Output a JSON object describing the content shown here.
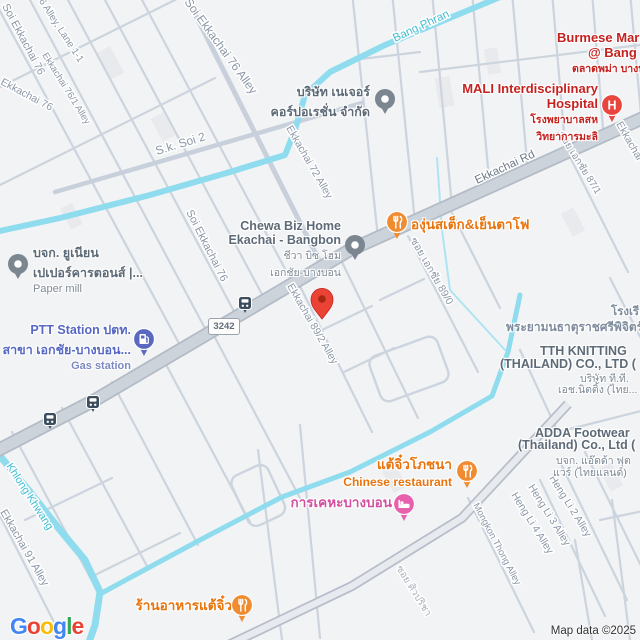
{
  "attribution": "Map data ©2025",
  "logo": {
    "letters": [
      "G",
      "o",
      "o",
      "g",
      "l",
      "e"
    ]
  },
  "route_shield": "3242",
  "canals": {
    "bang_phran": "Bang Phran",
    "khlong_khwang": "Khlong Khwang"
  },
  "streets": {
    "soi_ekkachai_76": "Soi Ekkachai 76",
    "ekkachai_76_lane_1_1": "Ekkachai 76 Alley, Lane 1-1",
    "ekkachai_76": "Ekkachai 76",
    "ekkachai_76_1_alley": "Ekkachai 76/1 Alley",
    "soi_ekkachai_76_alley": "Soi Ekkachai 76 Alley",
    "soi_ekkachai_76_lower": "Soi Ekkachai 76",
    "sk_soi_2": "S.k. Soi 2",
    "ekkachai_72_alley": "Ekkachai 72 Alley",
    "ekkachai_rd": "Ekkachai Rd",
    "ekkachai_clipped": "Ekkachai",
    "soi_ekachai_87_1": "ซอย เอกชัย 87/1",
    "soi_ekachai_89_0": "ซอย เอกชัย 89/0",
    "ekkachai_89_2_alley": "Ekkachai 89/2 Alley",
    "mongkon_thong_alley": "Mongkon Thong Alley",
    "heng_li_2_alley": "Heng Li 2 Alley",
    "heng_li_3_alley": "Heng Li 3 Alley",
    "heng_li_4_alley": "Heng Li 4 Alley",
    "ekkachai_91_alley": "Ekkachai 91 Alley",
    "soi_siwaricha": "ซอย ศิวปริชา"
  },
  "pois": {
    "burmese_market": {
      "lines": [
        "Burmese Market",
        "@ Bang Bon",
        "ตลาดพม่า บางบอน"
      ]
    },
    "mali_hospital": {
      "lines": [
        "MALI Interdisciplinary",
        "Hospital",
        "โรงพยาบาลสห",
        "วิทยาการมะลิ"
      ],
      "icon": "hospital-icon"
    },
    "nature_corp": {
      "lines": [
        "บริษัท เนเจอร์",
        "คอร์ปอเรชั่น จำกัด"
      ]
    },
    "chewa_biz_home": {
      "lines": [
        "Chewa Biz Home",
        "Ekachai - Bangbon",
        "ชีวา บิซ โฮม",
        "เอกชัย-บางบอน"
      ]
    },
    "grape_steak": {
      "name": "องุ่นสเต็ก&เย็นตาโฟ",
      "icon": "restaurant-icon"
    },
    "paper_mill": {
      "lines": [
        "บจก. ยูเนียน",
        "เปเปอร์คารตอนส์ |...",
        "Paper mill"
      ]
    },
    "ptt_station": {
      "lines": [
        "PTT Station ปตท.",
        "สาขา เอกชัย-บางบอน...",
        "Gas station"
      ],
      "icon": "gas-station-icon"
    },
    "school": {
      "lines": [
        "โรงเรียน",
        "พระยามนธาตุราชศรีพิจิตร์"
      ]
    },
    "tth_knitting": {
      "lines": [
        "TTH KNITTING",
        "(THAILAND) CO., LTD (",
        "บริษัท ที.ที.",
        "เอช.นิตติ้ง (ไทย..."
      ]
    },
    "adda_footwear": {
      "lines": [
        "ADDA Footwear",
        "(Thailand) Co., Ltd (",
        "บจก. แอ๊ดด้า ฟุต",
        "แวร์ (ไทยแลนด์)"
      ]
    },
    "teochew_restaurant": {
      "name": "แต้จิ๋วโภชนา",
      "sub": "Chinese restaurant",
      "icon": "restaurant-icon"
    },
    "bangbon_housing": {
      "name": "การเคหะบางบอน",
      "icon": "hotel-icon"
    },
    "teochew_restaurant_2": {
      "name": "ร้านอาหารแต้จิ๋ว",
      "icon": "restaurant-icon"
    }
  },
  "colors": {
    "red_pin": "#EA4335",
    "hospital": "#E8453C",
    "restaurant": "#EF8C32",
    "hotel": "#E85FAE",
    "gas": "#5B68C0",
    "gray_poi": "#7B8691",
    "canal": "#8EDCEE",
    "road_major": "#CCD3DB",
    "label_red": "#C5221F",
    "label_orange": "#E8740E",
    "label_pink": "#D44FA0",
    "label_blue": "#5667C4",
    "label_street": "#8B97A7"
  }
}
